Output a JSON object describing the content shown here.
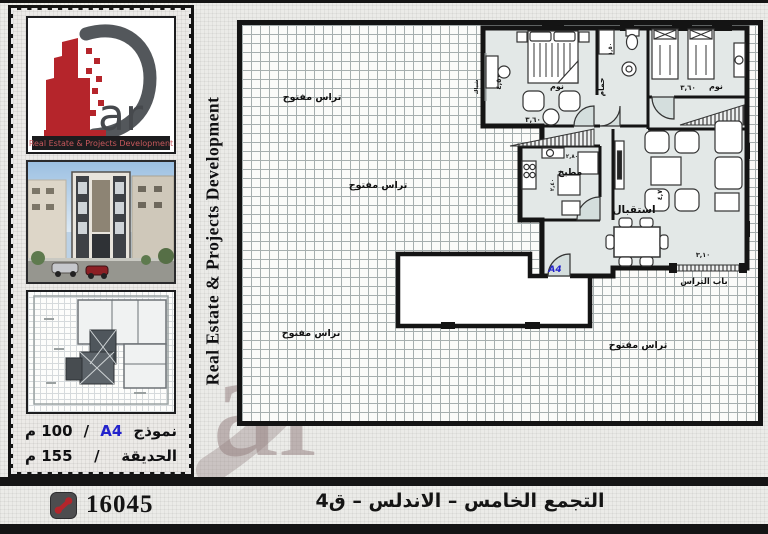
{
  "brand": {
    "logo_text": "ar",
    "band_text": "Real Estate & Projects Development",
    "vertical_text": "Real Estate & Projects Development"
  },
  "sidebar": {
    "info": {
      "row1_label": "نموذج",
      "row1_model": "A4",
      "row1_slash": "/",
      "row1_value": "100 م",
      "row2_label": "الحديقة",
      "row2_slash": "/",
      "row2_value": "155 م"
    }
  },
  "plan": {
    "labels": {
      "terrace": "تراس مفتوح",
      "bedroom": "نوم",
      "bathroom": "حمام",
      "kitchen": "مطبخ",
      "reception": "استقبال",
      "terrace_door": "باب التراس",
      "window": "شباك",
      "unit": "A4"
    },
    "dims": {
      "d360": "٣,٦٠",
      "d450": "٤,٥٠",
      "d150": "١,٥٠",
      "d280": "٢,٨٠",
      "d240": "٢,٤٠",
      "d47": "٤,٧",
      "d310": "٣,١٠"
    }
  },
  "footer": {
    "phone_number": "16045",
    "caption": "التجمع الخامس – الاندلس – ق4"
  },
  "colors": {
    "accent_red": "#b5252b",
    "brand_gray": "#53575b",
    "model_blue": "#2323cc",
    "floor": "#e3e8e7"
  }
}
